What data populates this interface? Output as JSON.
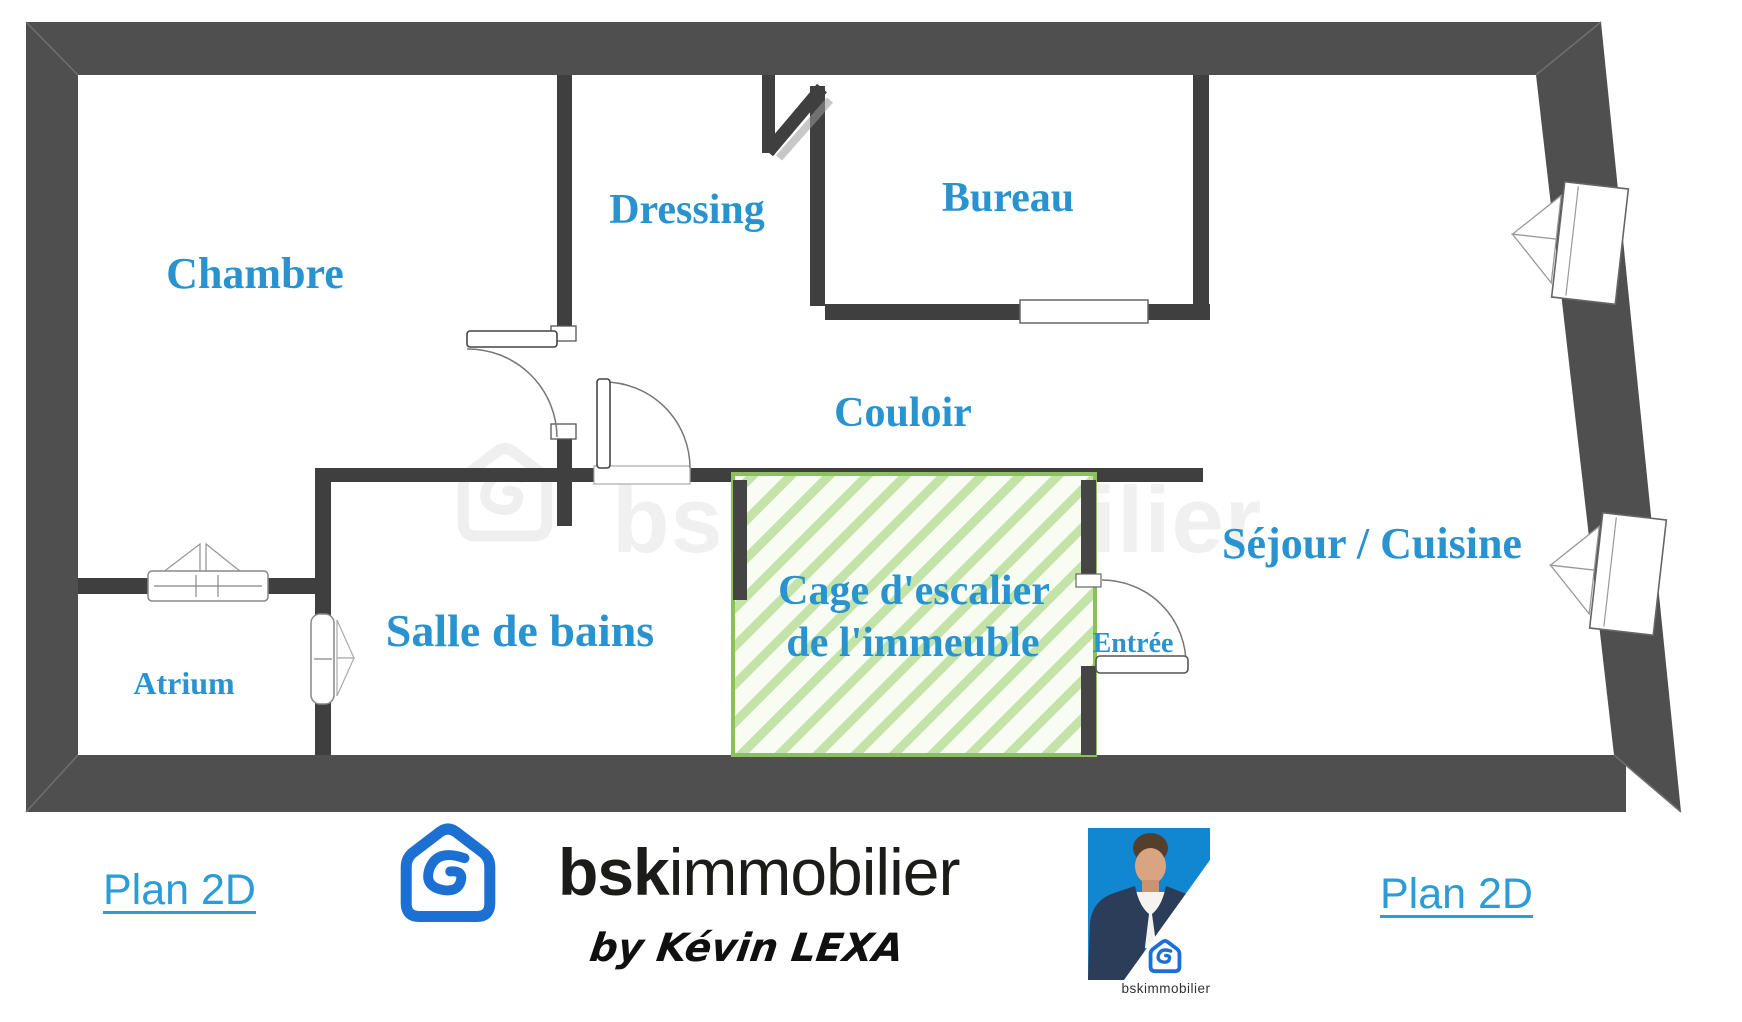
{
  "plan": {
    "rooms": {
      "chambre": "Chambre",
      "dressing": "Dressing",
      "bureau": "Bureau",
      "couloir": "Couloir",
      "salle_de_bains": "Salle de bains",
      "atrium": "Atrium",
      "sejour_cuisine": "Séjour / Cuisine",
      "entree": "Entrée",
      "cage_line1": "Cage d'escalier",
      "cage_line2": "de l'immeuble"
    },
    "watermark": "bskimmobilier",
    "colors": {
      "label_blue": "#2893cf",
      "outer_wall_gray": "#4f4f4f",
      "inner_wall_gray": "#3f3f3f",
      "cage_hatch_green": "#c3e3a8",
      "cage_border_green": "#8cc05f"
    }
  },
  "footer": {
    "plan2d_left": "Plan 2D",
    "plan2d_right": "Plan 2D",
    "brand_bold": "bsk",
    "brand_light": "immobilier",
    "byline": "by Kévin LEXA",
    "badge_label": "bskimmobilier",
    "icons": {
      "logo": "bsk-house-icon",
      "agent_photo": "agent-portrait"
    },
    "colors": {
      "link_blue": "#2b9cd8",
      "brand_blue": "#1c70d3",
      "photo_blue": "#1186d1"
    }
  }
}
